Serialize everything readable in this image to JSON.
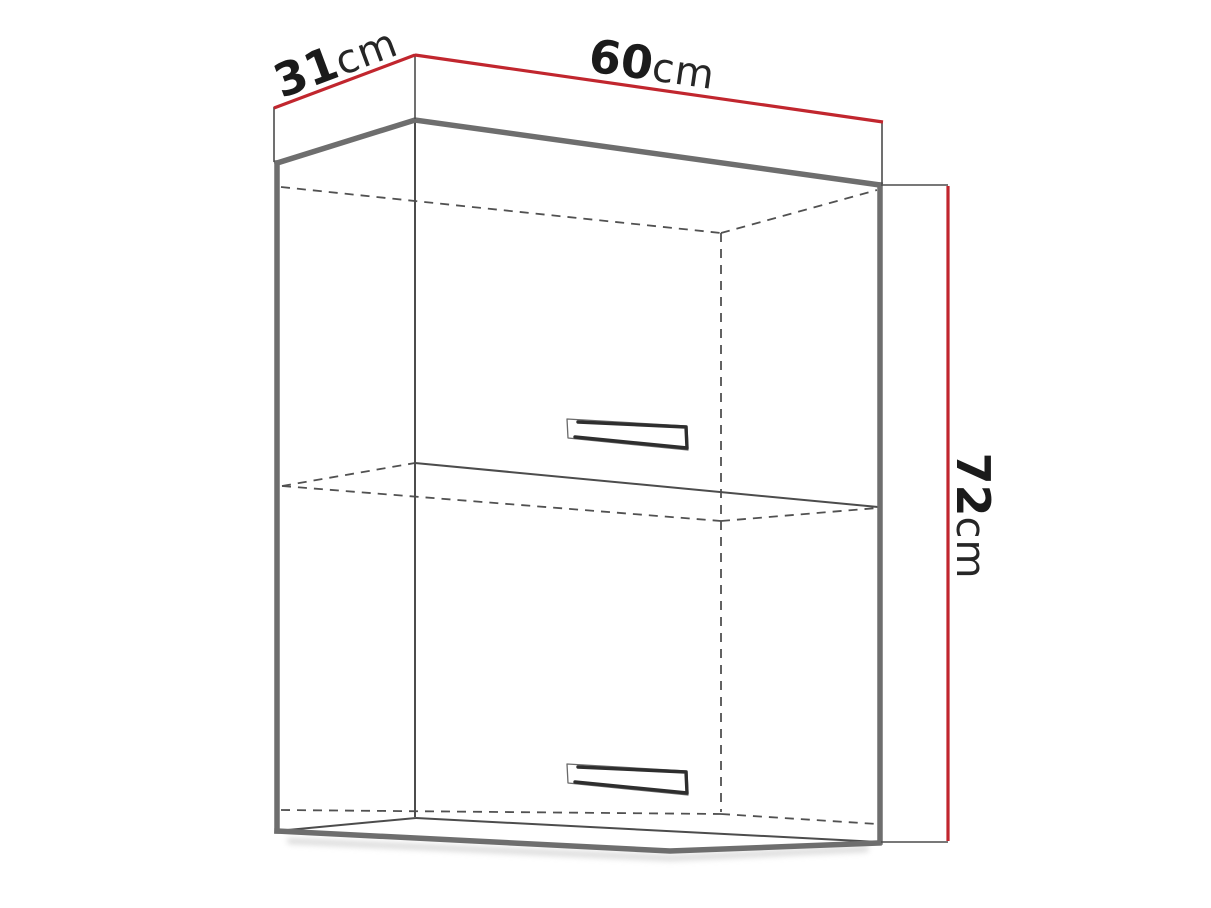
{
  "diagram": {
    "kind": "wall-cabinet-dimension-drawing",
    "background_color": "#ffffff",
    "accent_color": "#c1262e",
    "outline_color": "#6e6e6e",
    "dimensions": {
      "depth": {
        "value": "31",
        "unit": "cm"
      },
      "width": {
        "value": "60",
        "unit": "cm"
      },
      "height": {
        "value": "72",
        "unit": "cm"
      }
    }
  }
}
